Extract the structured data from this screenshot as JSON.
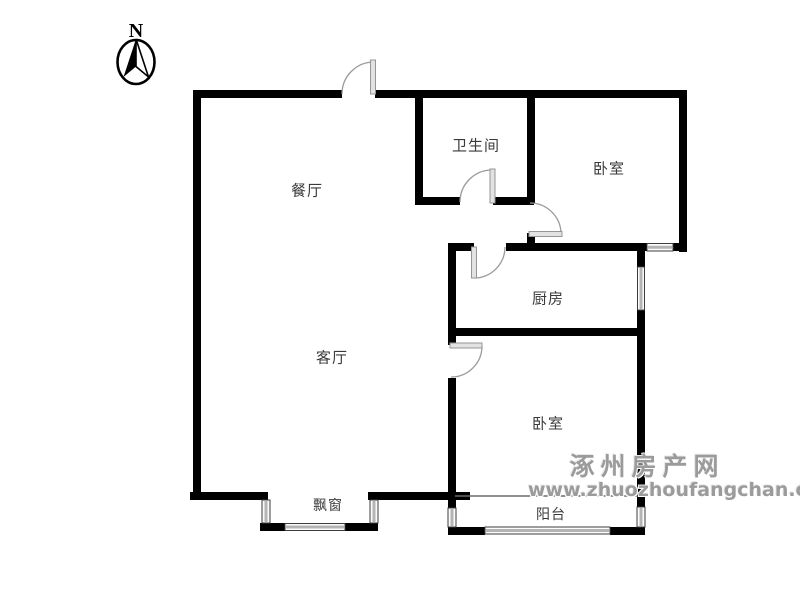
{
  "compass": {
    "label": "N"
  },
  "rooms": {
    "dining": {
      "label": "餐厅"
    },
    "bathroom": {
      "label": "卫生间"
    },
    "bedroom_top": {
      "label": "卧室"
    },
    "kitchen": {
      "label": "厨房"
    },
    "living": {
      "label": "客厅"
    },
    "bedroom_bottom": {
      "label": "卧室"
    },
    "bay_window": {
      "label": "飘窗"
    },
    "balcony": {
      "label": "阳台"
    }
  },
  "watermark": {
    "site_name": "涿州房产网",
    "site_url": "www.zhuozhoufangchan.com"
  },
  "colors": {
    "wall": "#000000",
    "door_arc": "#9a9a9a",
    "window_line": "#b4b4b4",
    "label_text": "#3a3a3a",
    "watermark_text": "#9b9b9b",
    "background": "#ffffff"
  }
}
